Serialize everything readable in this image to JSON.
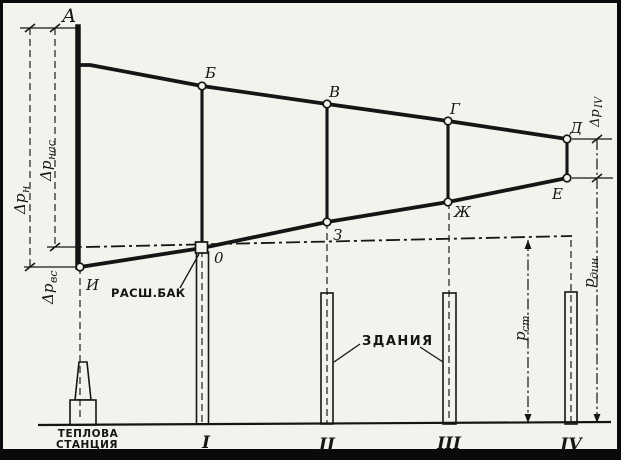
{
  "colors": {
    "background": "#f3f2ed",
    "ink": "#151515"
  },
  "points": {
    "a": "А",
    "b": "Б",
    "v": "В",
    "g": "Г",
    "d": "Д",
    "e": "Е",
    "zh": "Ж",
    "z": "З",
    "i": "И",
    "o": "0"
  },
  "dims": {
    "dp_n": {
      "base": "Δp",
      "sub": "н"
    },
    "dp_nas": {
      "base": "Δp",
      "sub": "нас"
    },
    "dp_vs": {
      "base": "Δp",
      "sub": "вс"
    },
    "dp_iv": {
      "base": "Δp",
      "sub": "IV"
    },
    "p_st": {
      "base": "p",
      "sub": "ст"
    },
    "p_din": {
      "base": "p",
      "sub": "дин"
    }
  },
  "labels": {
    "expansion_tank": "РАСШ.БАК",
    "buildings": "ЗДАНИЯ",
    "station": [
      "ТЕПЛОВА",
      "СТАНЦИЯ"
    ]
  },
  "numerals": [
    "I",
    "II",
    "III",
    "IV"
  ]
}
